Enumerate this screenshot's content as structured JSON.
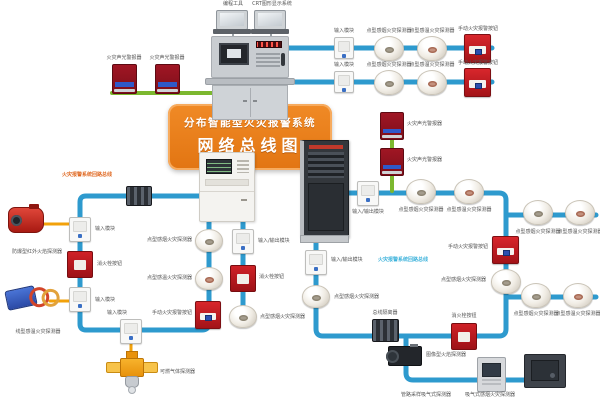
{
  "banner": {
    "line1": "分布智能型火灾报警系统",
    "line2": "网络总线图"
  },
  "labels": {
    "prog": "编程工具",
    "crt": "CRT图形显示系统",
    "input": "输入模块",
    "io": "输入/输出模块",
    "smoke": "点型感烟火灾探测器",
    "heat": "点型感温火灾探测器",
    "manual": "手动火灾报警按钮",
    "hydrant": "消火栓按钮",
    "alarm": "火灾声光警报器",
    "flame": "防爆型红外火焰探测器",
    "linear": "线型感温火灾探测器",
    "gas": "可燃气体探测器",
    "isolator": "总线隔离器",
    "camera": "图像型火焰探测器",
    "asp_pipe": "管路采样吸气式探测器",
    "asp_smoke": "吸气式感烟火灾探测器",
    "loop_bus": "火灾报警系统回路总线"
  },
  "colors": {
    "bus_blue": "#2e9ace",
    "branch_green": "#7cb82f",
    "link_yellow": "#f2a10a",
    "banner_orange": "#e87f1d",
    "device_red": "#c4161c"
  }
}
